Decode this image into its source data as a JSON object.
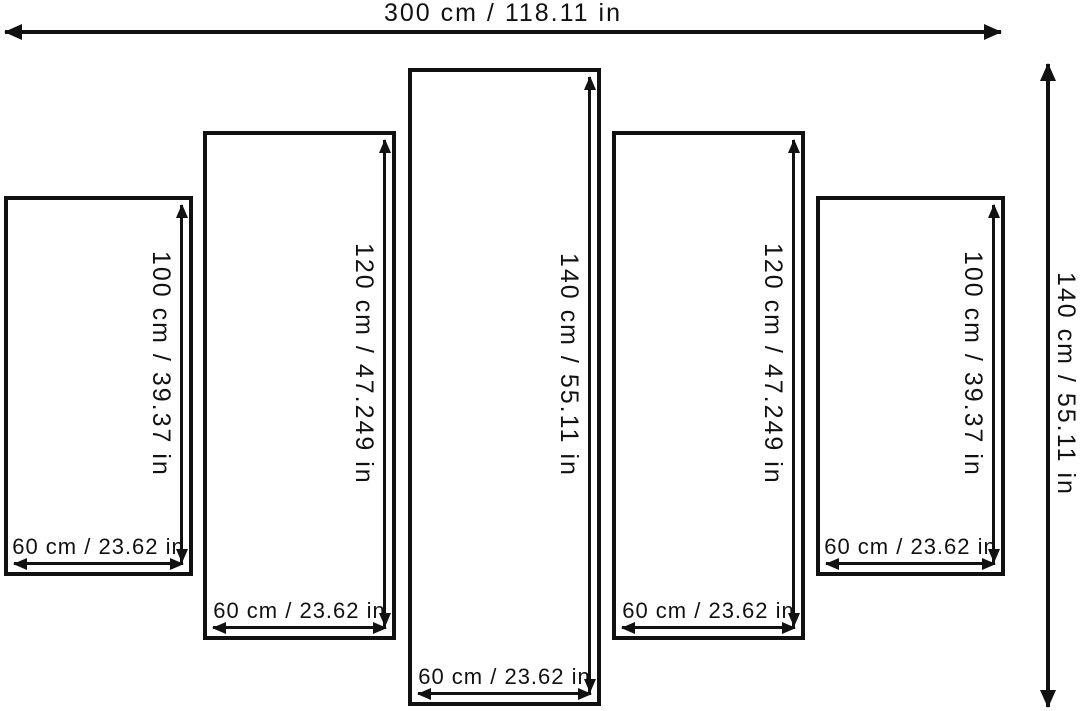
{
  "diagram": {
    "type": "multi-panel-canvas-dimensions",
    "panel_count": 5,
    "overall_width_label": "300 cm / 118.11 in",
    "overall_height_label": "140 cm / 55.11 in",
    "panels": [
      {
        "position": "left-outer",
        "height_label": "100 cm / 39.37 in",
        "width_label": "60 cm / 23.62 in"
      },
      {
        "position": "left-inner",
        "height_label": "120 cm / 47.249 in",
        "width_label": "60 cm / 23.62 in"
      },
      {
        "position": "center",
        "height_label": "140 cm / 55.11 in",
        "width_label": "60 cm / 23.62 in"
      },
      {
        "position": "right-inner",
        "height_label": "120 cm / 47.249 in",
        "width_label": "60 cm / 23.62 in"
      },
      {
        "position": "right-outer",
        "height_label": "100 cm / 39.37 in",
        "width_label": "60 cm / 23.62 in"
      }
    ],
    "colors": {
      "line": "#111111",
      "text": "#111111",
      "background": "#ffffff"
    }
  }
}
